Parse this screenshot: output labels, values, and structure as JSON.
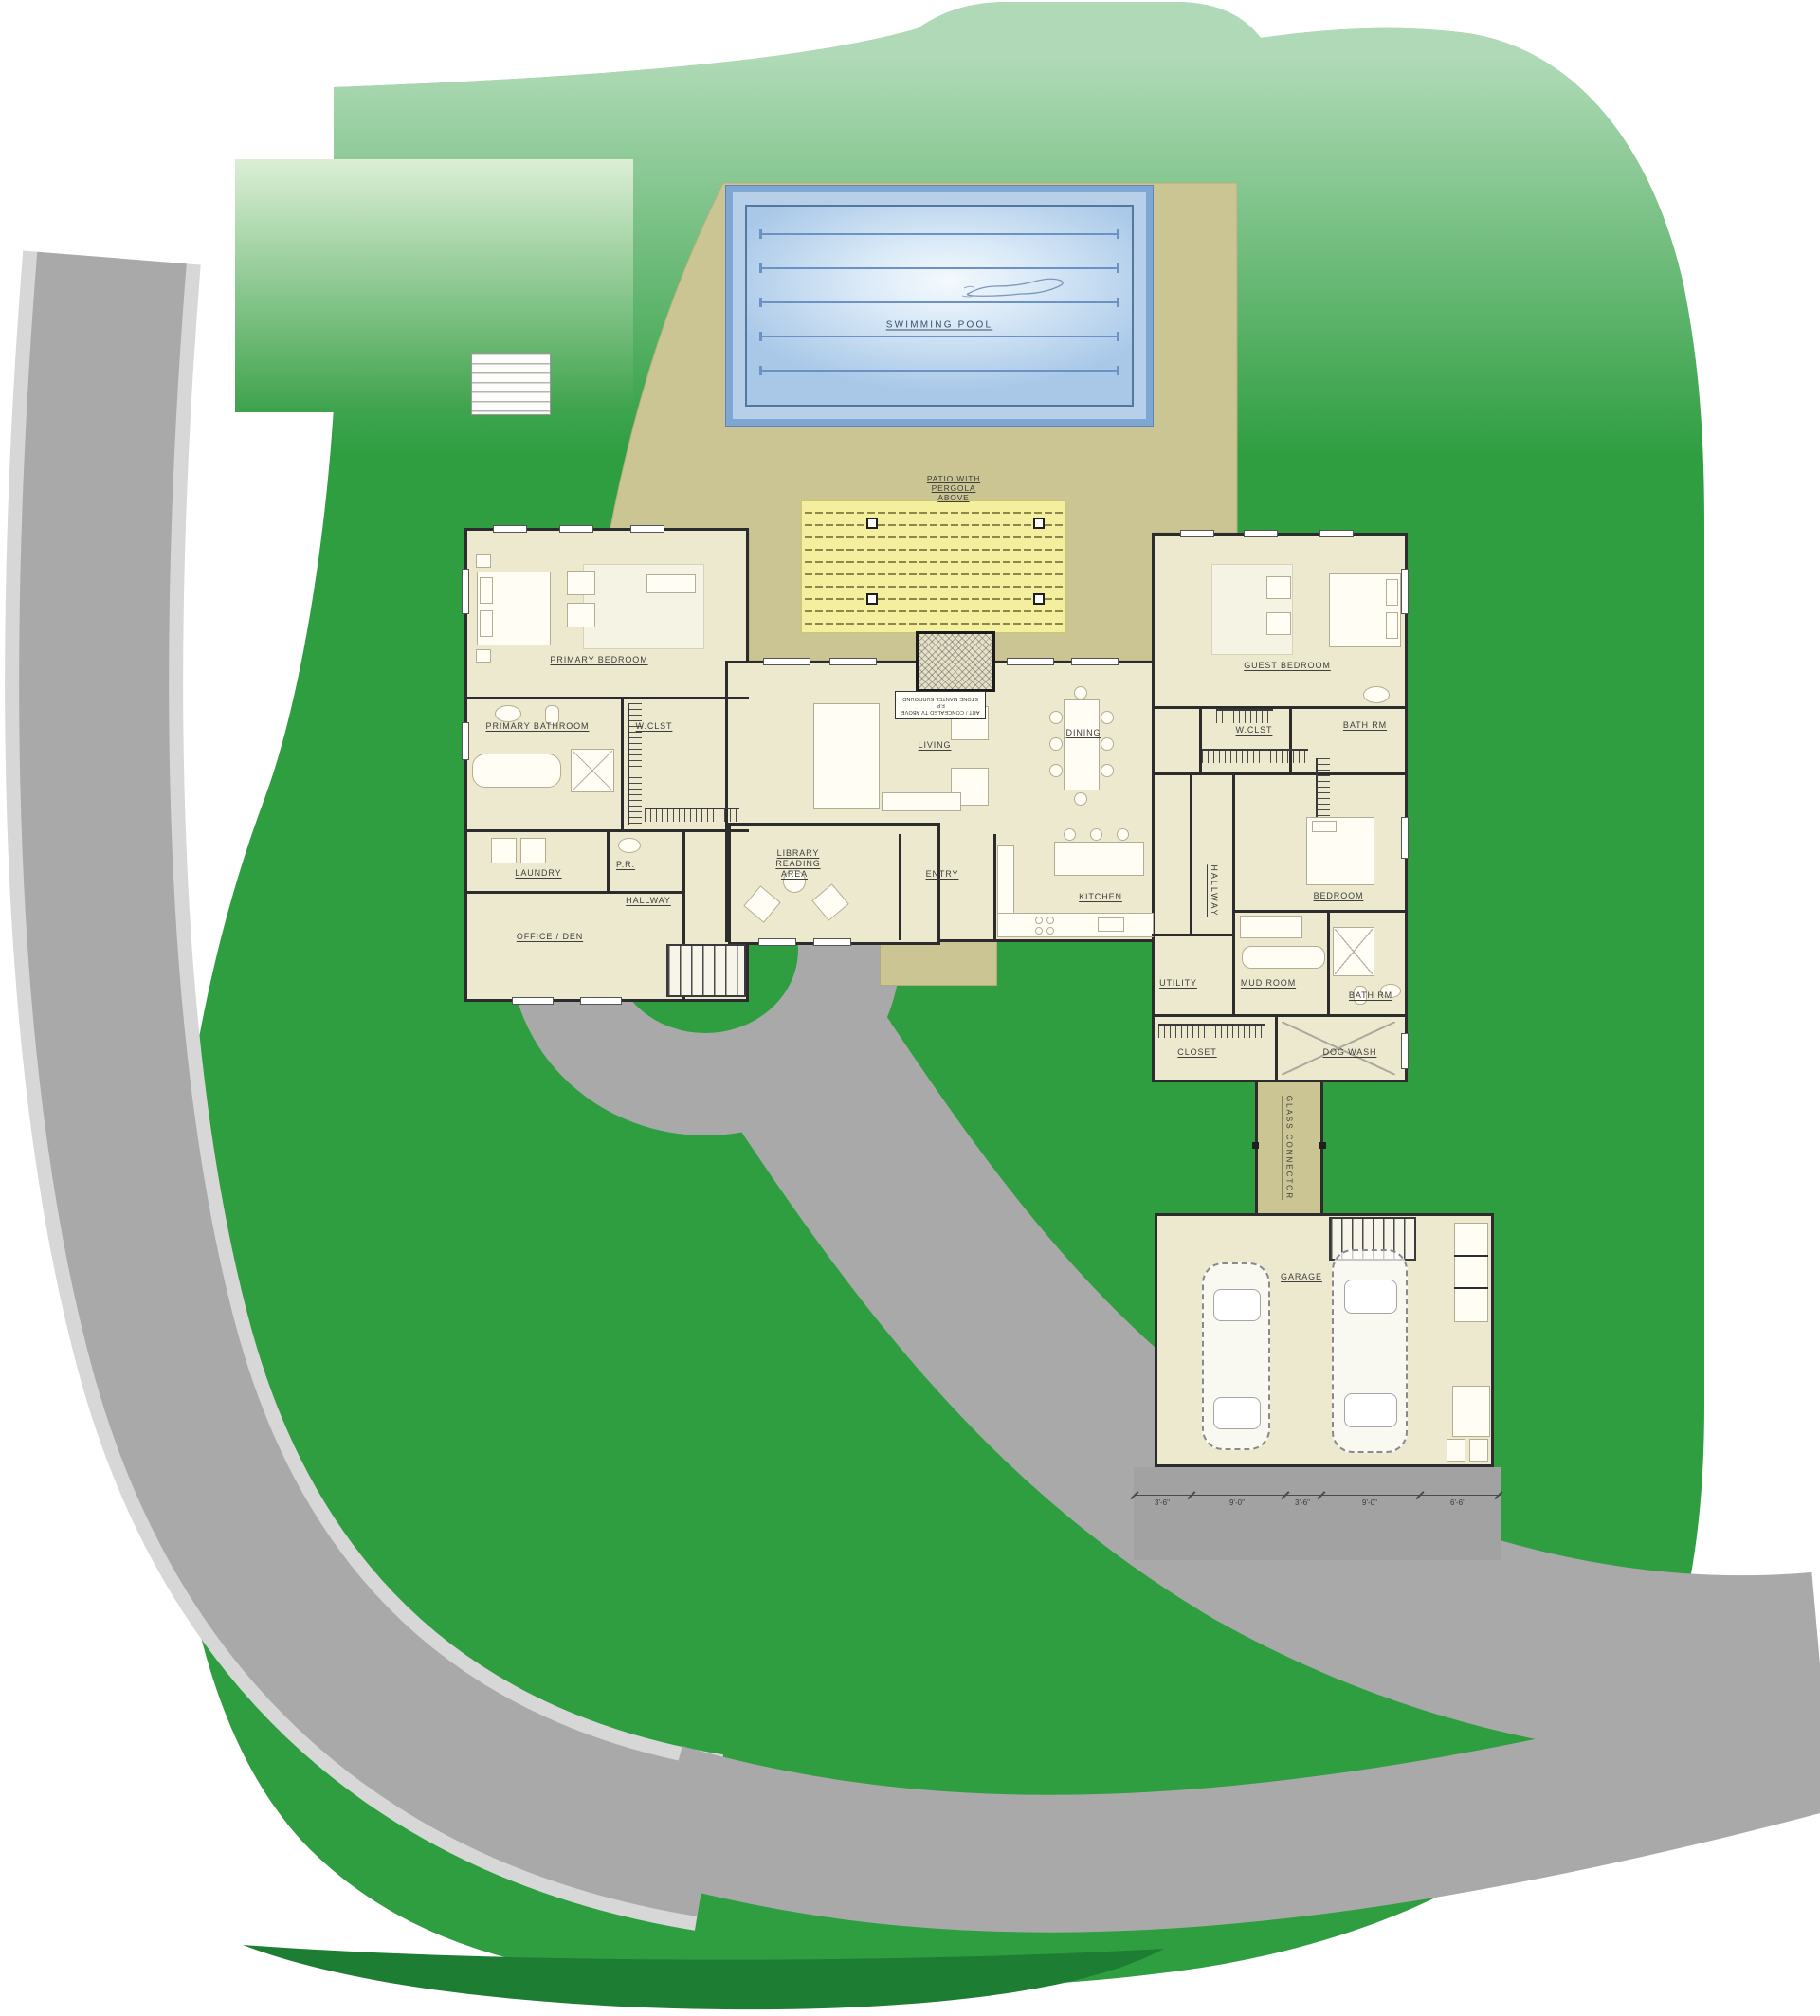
{
  "site": {
    "swimming_pool_label": "SWIMMING POOL",
    "patio_label_line1": "PATIO WITH",
    "patio_label_line2": "PERGOLA",
    "patio_label_line3": "ABOVE",
    "glass_connector_label": "GLASS CONNECTOR"
  },
  "rooms": {
    "primary_bedroom": "PRIMARY BEDROOM",
    "primary_bathroom": "PRIMARY BATHROOM",
    "wclst_left": "W.CLST",
    "laundry": "LAUNDRY",
    "powder_room": "P.R.",
    "hallway_left": "HALLWAY",
    "office_den": "OFFICE  /  DEN",
    "library_line1": "LIBRARY",
    "library_line2": "READING",
    "library_line3": "AREA",
    "living": "LIVING",
    "dining": "DINING",
    "entry": "ENTRY",
    "kitchen": "KITCHEN",
    "guest_bedroom": "GUEST BEDROOM",
    "wclst_right": "W.CLST",
    "bath_rm_upper": "BATH RM",
    "hallway_right": "HALLWAY",
    "bedroom": "BEDROOM",
    "utility": "UTILITY",
    "mud_room": "MUD ROOM",
    "bath_rm_lower": "BATH RM",
    "closet": "CLOSET",
    "dog_wash": "DOG WASH",
    "garage": "GARAGE"
  },
  "fireplace_note": {
    "line1": "STONE MANTEL SURROUND",
    "line2": "ART / CONCEALED TV ABOVE F.P."
  },
  "garage_dimensions": [
    "3'-6\"",
    "9'-0\"",
    "3'-6\"",
    "9'-0\"",
    "6'-6\""
  ],
  "colors": {
    "lawn": "#2f9e41",
    "road": "#a9a9a9",
    "terrace": "#cbc493",
    "pergola_patio": "#f4ef9e",
    "pool_water": "#dcebf8",
    "pool_frame": "#7fa7d3",
    "floor": "#ece9ce",
    "wall": "#2c2c2c"
  }
}
